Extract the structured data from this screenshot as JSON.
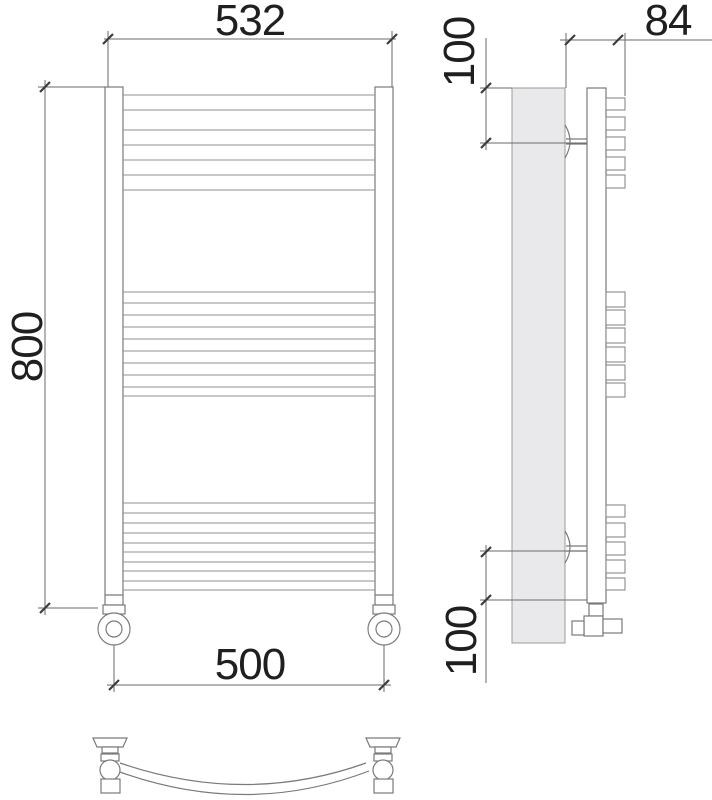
{
  "drawing": {
    "type": "technical-drawing",
    "subject": "curved ladder towel radiator, three orthographic views",
    "line_color": "#7a7a7a",
    "dimension_line_color": "#6a6a6a",
    "text_color": "#1f1f1f",
    "plate_fill": "#e9e9eb",
    "labels": {
      "top_width": "532",
      "height": "800",
      "bottom_width": "500",
      "side_top_offset": "100",
      "side_depth": "84",
      "side_bottom_offset": "100"
    }
  }
}
